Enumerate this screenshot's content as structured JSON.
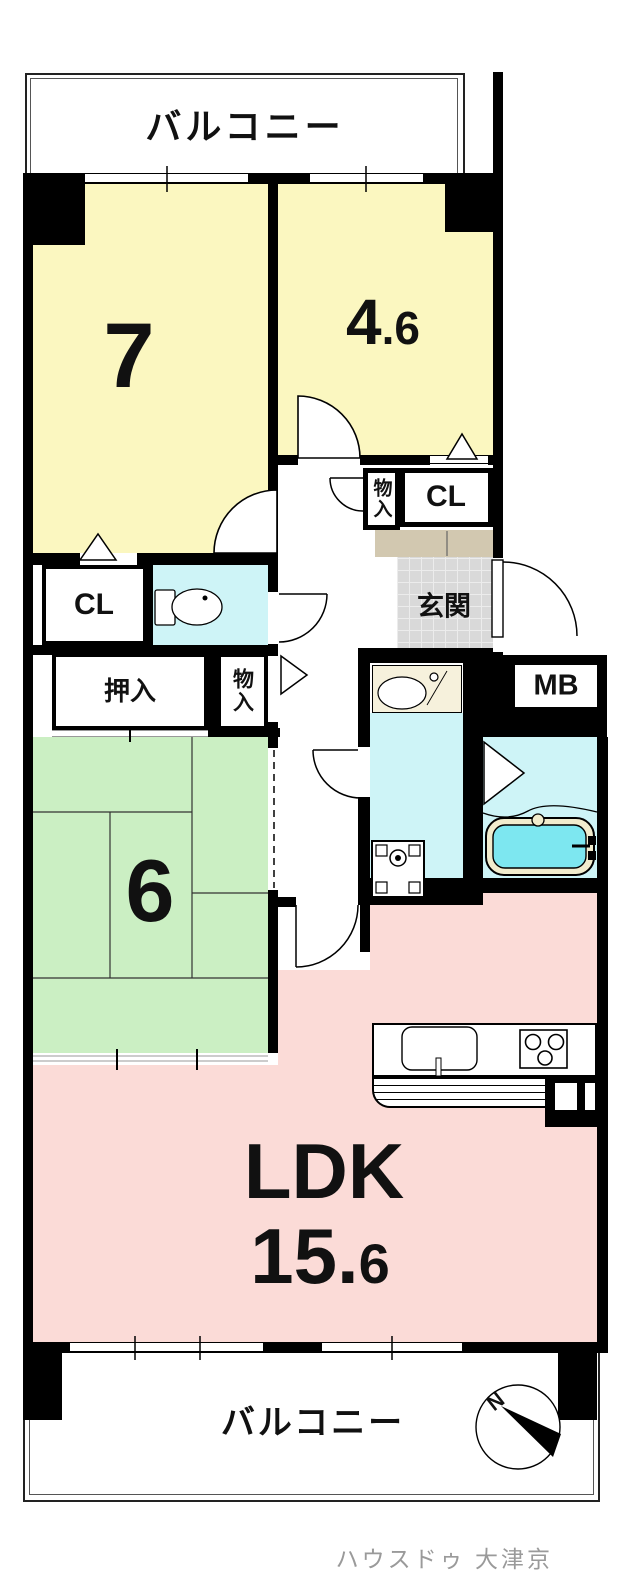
{
  "labels": {
    "balcony_top": "バルコニー",
    "balcony_bottom": "バルコニー",
    "room7_size": "7",
    "room46_int": "4",
    "room46_dec": ".6",
    "closet_top": "CL",
    "closet_left": "CL",
    "storage_top": "物入",
    "storage_left": "物入",
    "entrance": "玄関",
    "oshiire": "押入",
    "meter_box": "MB",
    "tatami_size": "6",
    "ldk_name": "LDK",
    "ldk_int": "15.",
    "ldk_dec": "6",
    "compass_north": "N",
    "watermark": "ハウスドゥ 大津京"
  },
  "fixtures": [
    "toilet-icon",
    "vanity-sink-icon",
    "washing-machine-icon",
    "bathtub-icon",
    "kitchen-sink-icon",
    "stove-burners-icon",
    "compass-icon",
    "door-swing-icon",
    "folding-door-triangle-icon"
  ],
  "colors": {
    "wall": "#000000",
    "room_yellow": "#FBF7C0",
    "tatami_green": "#CBEFC3",
    "ldk_pink": "#FBDBD7",
    "wet_area_cyan": "#CEF4F7",
    "bath_water_cyan": "#7DE7F0",
    "entry_tile_gray": "#D9D9D9",
    "step_beige": "#D2C8B0",
    "vanity_cream": "#F6F1DC",
    "tub_rim_cream": "#F1ECCD",
    "watermark_gray": "#9A9A9A"
  }
}
